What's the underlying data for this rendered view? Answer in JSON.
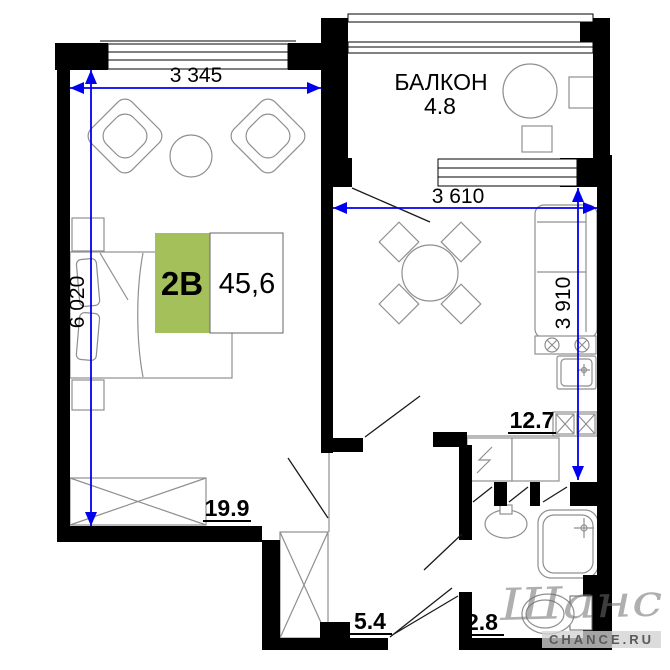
{
  "plan": {
    "type_label": "2В",
    "total_area": "45,6",
    "balcony": {
      "name": "БАЛКОН",
      "area": "4.8"
    },
    "rooms": {
      "living": "19.9",
      "kitchen": "12.7",
      "hall": "5.4",
      "bath": "2.8"
    },
    "dimensions": {
      "top_width": "3 345",
      "left_height": "6 020",
      "kitchen_width": "3 610",
      "kitchen_height": "3 910"
    },
    "watermark": {
      "script": "Шанс",
      "site": "CHANCE.RU"
    }
  },
  "colors": {
    "wall_black": "#000000",
    "dimension_blue": "#0000ee",
    "furniture_gray": "#8f8f8f",
    "accent_green": "#a4c05a"
  }
}
